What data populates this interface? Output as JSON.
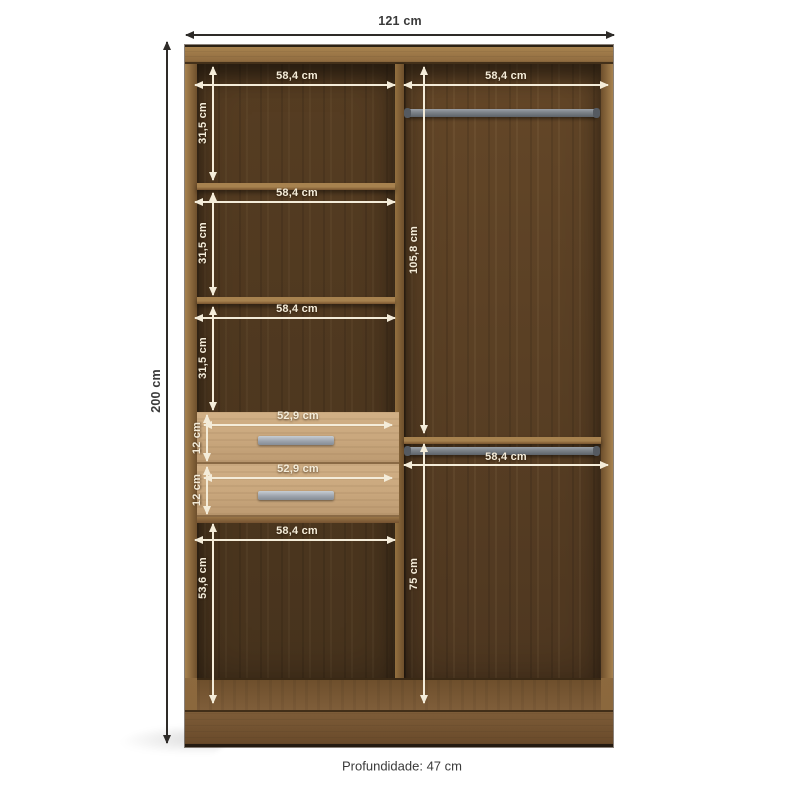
{
  "overall": {
    "width": "121 cm",
    "height": "200 cm",
    "depth": "Profundidade: 47 cm"
  },
  "left_column": {
    "section1": {
      "width": "58,4 cm",
      "height": "31,5 cm"
    },
    "section2": {
      "width": "58,4 cm",
      "height": "31,5 cm"
    },
    "section3": {
      "width": "58,4 cm",
      "height": "31,5 cm"
    },
    "drawer1": {
      "width": "52,9 cm",
      "height": "12 cm"
    },
    "drawer2": {
      "width": "52,9 cm",
      "height": "12 cm"
    },
    "bottom": {
      "width": "58,4 cm",
      "height": "53,6 cm"
    }
  },
  "right_column": {
    "upper": {
      "width": "58,4 cm",
      "height": "105,8 cm"
    },
    "lower": {
      "width": "58,4 cm",
      "height": "75 cm"
    }
  },
  "colors": {
    "frame": "#9b774a",
    "interior_left": "#563d22",
    "interior_right": "#644728",
    "drawer": "#c9a77d",
    "rod": "#7b8187",
    "handle": "#9aa1aa",
    "dim_light": "#f4ecd9",
    "dim_dark": "#2e2b28"
  }
}
